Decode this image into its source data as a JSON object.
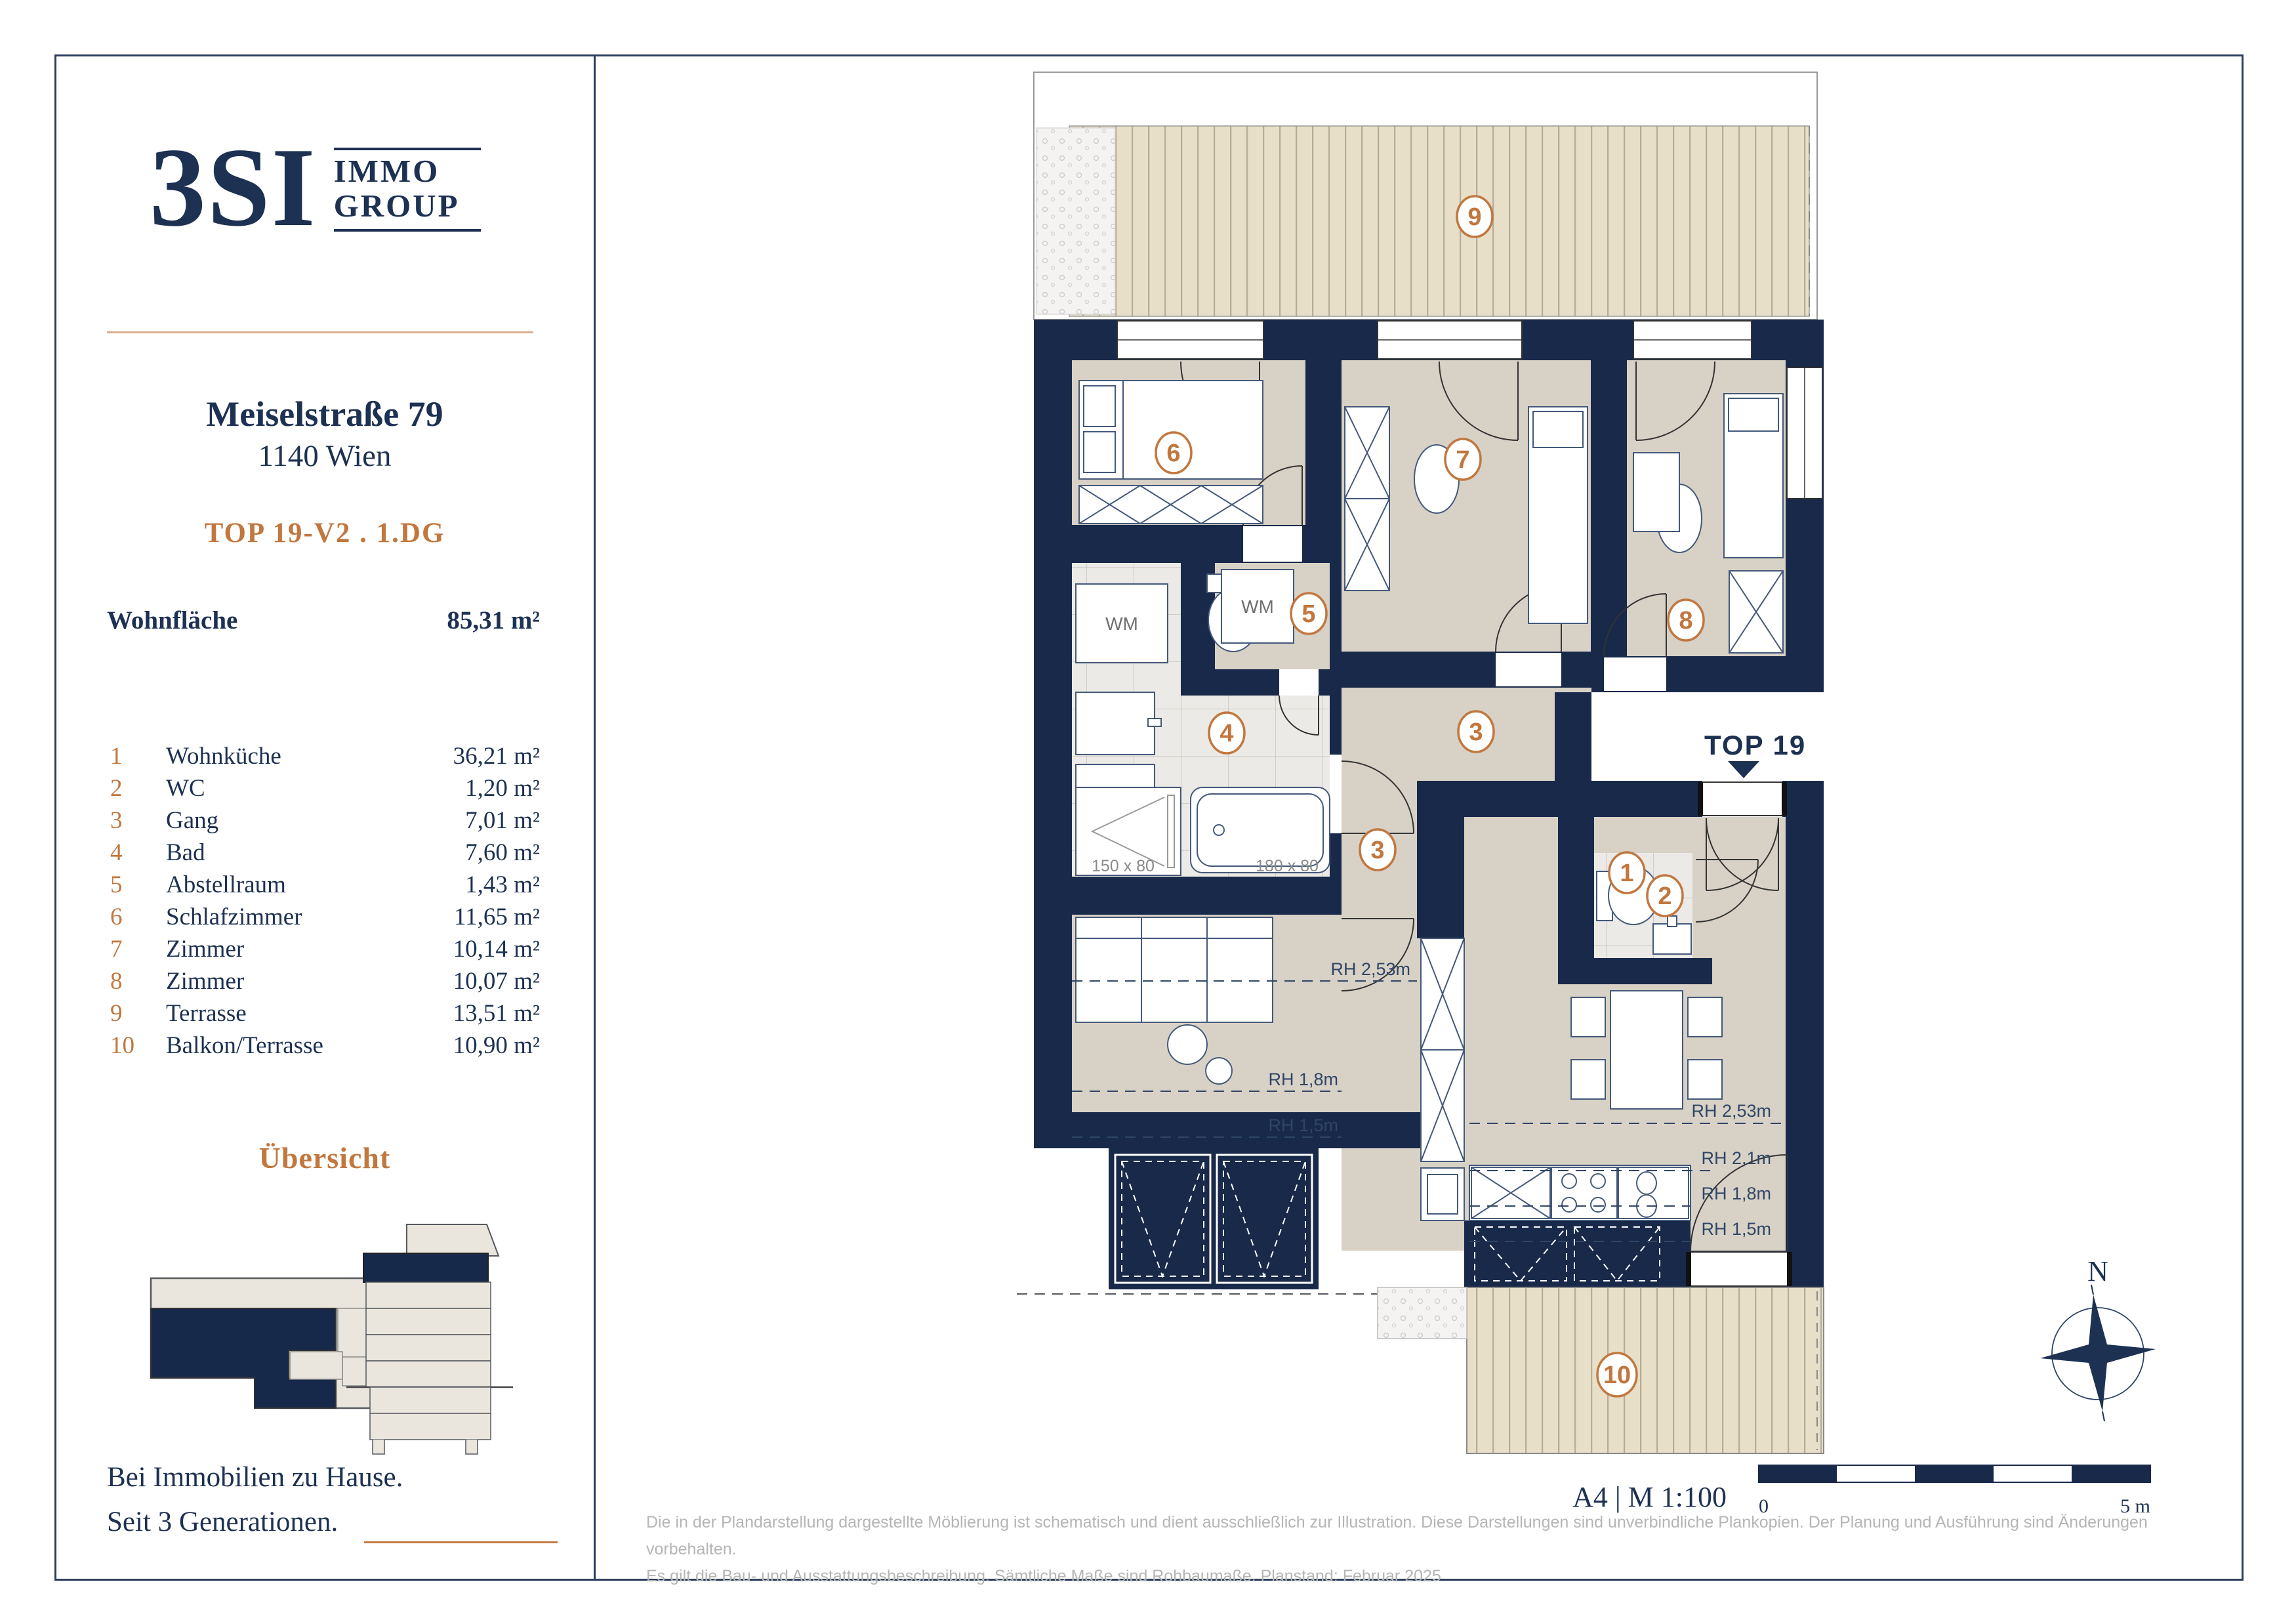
{
  "brand": {
    "logo_main": "3SI",
    "logo_word1": "IMMO",
    "logo_word2": "GROUP",
    "tagline_line1": "Bei Immobilien zu Hause.",
    "tagline_line2": "Seit 3 Generationen."
  },
  "header": {
    "address_line1": "Meiselstraße 79",
    "address_line2": "1140 Wien",
    "unit_label": "TOP 19-V2 . 1.DG"
  },
  "area_summary": {
    "label": "Wohnfläche",
    "value": "85,31 m²"
  },
  "rooms": [
    {
      "num": "1",
      "name": "Wohnküche",
      "area": "36,21 m²"
    },
    {
      "num": "2",
      "name": "WC",
      "area": "1,20 m²"
    },
    {
      "num": "3",
      "name": "Gang",
      "area": "7,01 m²"
    },
    {
      "num": "4",
      "name": "Bad",
      "area": "7,60 m²"
    },
    {
      "num": "5",
      "name": "Abstellraum",
      "area": "1,43 m²"
    },
    {
      "num": "6",
      "name": "Schlafzimmer",
      "area": "11,65 m²"
    },
    {
      "num": "7",
      "name": "Zimmer",
      "area": "10,14 m²"
    },
    {
      "num": "8",
      "name": "Zimmer",
      "area": "10,07 m²"
    },
    {
      "num": "9",
      "name": "Terrasse",
      "area": "13,51 m²"
    },
    {
      "num": "10",
      "name": "Balkon/Terrasse",
      "area": "10,90 m²"
    }
  ],
  "overview": {
    "title": "Übersicht"
  },
  "plan": {
    "entrance_label": "TOP 19",
    "scale_text": "A4 | M 1:100",
    "scale_zero": "0",
    "scale_end": "5 m",
    "compass_n": "N",
    "labels": {
      "wm": "WM",
      "shower_dim": "150 x 80",
      "tub_dim": "180 x 80",
      "rh253": "RH 2,53m",
      "rh21": "RH 2,1m",
      "rh18": "RH 1,8m",
      "rh15": "RH 1,5m"
    },
    "circles": [
      "1",
      "2",
      "3",
      "3",
      "4",
      "5",
      "6",
      "7",
      "8",
      "9",
      "10"
    ]
  },
  "footer": {
    "disclaimer_line1": "Die in der Plandarstellung dargestellte Möblierung ist schematisch und dient ausschließlich zur Illustration. Diese Darstellungen sind unverbindliche Plankopien. Der Planung und Ausführung sind Änderungen vorbehalten.",
    "disclaimer_line2": "Es gilt die Bau- und Ausstattungsbeschreibung. Sämtliche Maße sind Rohbaumaße. Planstand: Februar 2025"
  },
  "colors": {
    "navy_text": "#1d3152",
    "wall_navy": "#18294a",
    "accent_orange": "#c1773e",
    "room_beige": "#d8d1c6",
    "terrace_beige": "#e7dfc8",
    "stripe": "#b5ad99",
    "tile": "#eceae6",
    "outline_gray": "#8c8c8c",
    "disclaimer_gray": "#b5b5b5",
    "tan_rule": "#d9ae8a"
  }
}
